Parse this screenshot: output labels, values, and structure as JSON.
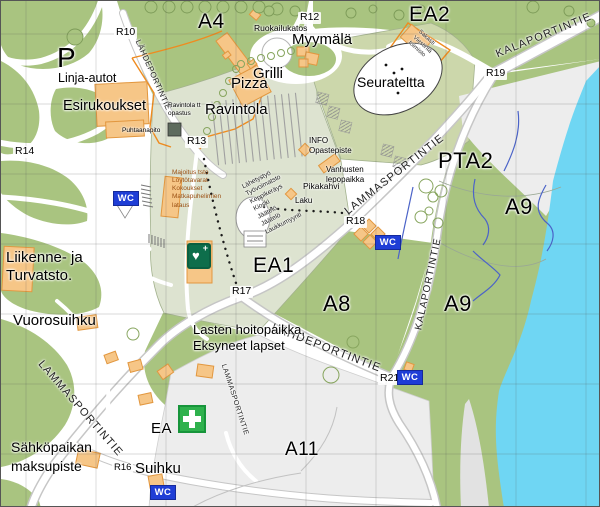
{
  "areas": {
    "p": "P",
    "a4": "A4",
    "ea2": "EA2",
    "pta2": "PTA2",
    "a9_north": "A9",
    "a9_south": "A9",
    "a8": "A8",
    "ea1": "EA1",
    "a11": "A11",
    "ea": "EA"
  },
  "nodes": {
    "r10": "R10",
    "r12": "R12",
    "r13": "R13",
    "r14": "R14",
    "r16": "R16",
    "r17": "R17",
    "r18": "R18",
    "r19": "R19",
    "r21": "R21"
  },
  "roads": {
    "kalaportintie_north": "KALAPORTINTIE",
    "kalaportintie_center": "KALAPORTINTIE",
    "lammasportintie_center": "LAMMASPORTINTIE",
    "lammasportintie_southwest": "LAMMASPORTINTIE",
    "lammasportintie_small": "LAMMASPORTINTIE",
    "lahdeportintie_north": "LÄHDEPORTINTIE",
    "lahdeportintie_south": "LÄHDEPORTINTIE"
  },
  "places": {
    "linja_autot": "Linja-autot",
    "esirukoukset": "Esirukoukset",
    "ravintola_opastus": "Ravintola tt\nopastus",
    "puhtaanapito": "Puhtaanapito",
    "ruokailukatos": "Ruokailukatos",
    "myymala": "Myymälä",
    "grilli": "Grilli",
    "pizza": "Pizza",
    "ravintola": "Ravintola",
    "seurateltta": "Seurateltta",
    "sakasti": "Sakasti\nViestintä\ntoimisto",
    "info": "INFO\nOpastepiste",
    "vanhusten": "Vanhusten\nlepopaikka",
    "pikakahvi": "Pikakahvi",
    "laku": "Laku",
    "majoitus": "Majoitus tsto\nLöytötavarat\nKokoukset\nMatkapuhelimien\nlataus",
    "myynti": "Lähetystyö\nTyövoimatsto\nKeppikeräys\nKioski\nJäätelö\nJäätelö\nLaukkumyynti",
    "liikenne": "Liikenne- ja\nTurvatsto.",
    "vuorosuihku": "Vuorosuihku",
    "lasten": "Lasten hoitopaikka,\nEksyneet lapset",
    "sahkopaikan": "Sähköpaikan\nmaksupiste",
    "suihku": "Suihku"
  },
  "badges": {
    "wc": "WC"
  },
  "colors": {
    "water": "#6fd6f3",
    "park_green": "#a9c480",
    "field_pale": "#dde3d0",
    "field_olive": "#ccd7ab",
    "parking_gray": "#ededed",
    "building_orange": "#f6c687",
    "building_outline": "#e2973f",
    "orange_boundary": "#ef8b1f",
    "wc_blue": "#1f3ed6",
    "first_aid_green": "#2fb14d",
    "defib_green": "#0e6e4b",
    "stream_blue": "#4b63c8"
  }
}
